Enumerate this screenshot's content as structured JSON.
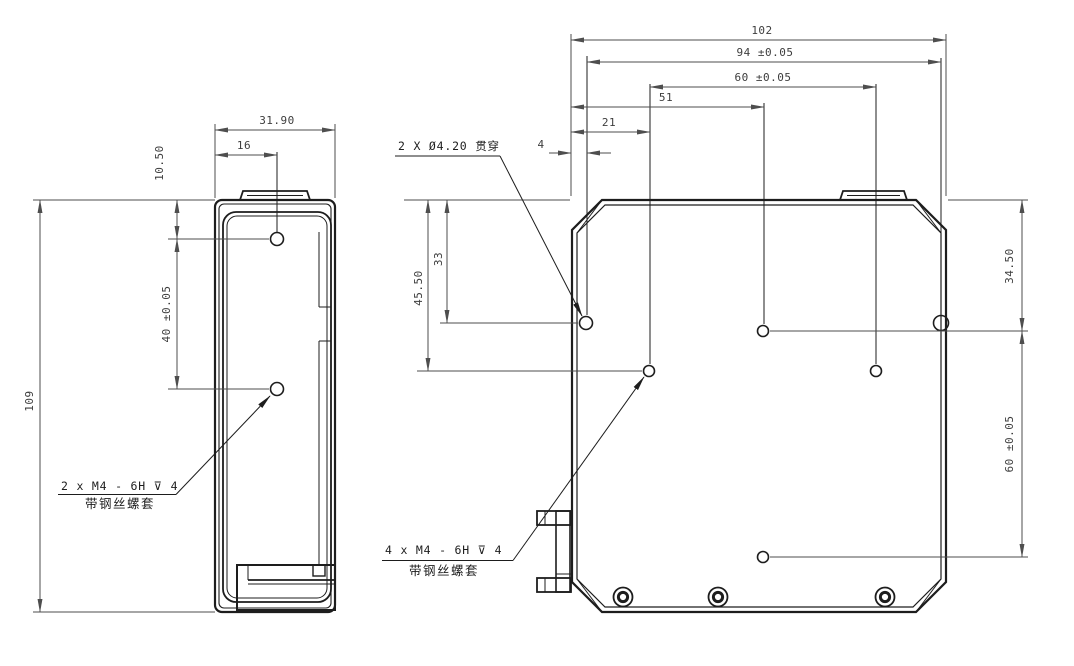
{
  "page": {
    "background": "#ffffff",
    "line_color": "#1d1d1d",
    "dim_color": "#4e4e4e"
  },
  "left_view": {
    "dim_width": "31.90",
    "dim_hole_offset_x": "16",
    "dim_hole_offset_top": "10.50",
    "dim_hole_spacing": "40 ±0.05",
    "dim_height": "109",
    "thread_note_line1": "2 x M4 - 6H ⊽ 4",
    "thread_note_line2": "带钢丝螺套"
  },
  "right_view": {
    "dim_overall_width": "102",
    "dim_width_94": "94 ±0.05",
    "dim_width_60": "60 ±0.05",
    "dim_width_51": "51",
    "dim_width_21": "21",
    "dim_width_4": "4",
    "dim_height_45_5": "45.50",
    "dim_height_33": "33",
    "dim_height_34_5": "34.50",
    "dim_height_60": "60 ±0.05",
    "hole_note": "2 X Ø4.20 贯穿",
    "thread_note_line1": "4 x M4 - 6H ⊽ 4",
    "thread_note_line2": "带钢丝螺套"
  }
}
